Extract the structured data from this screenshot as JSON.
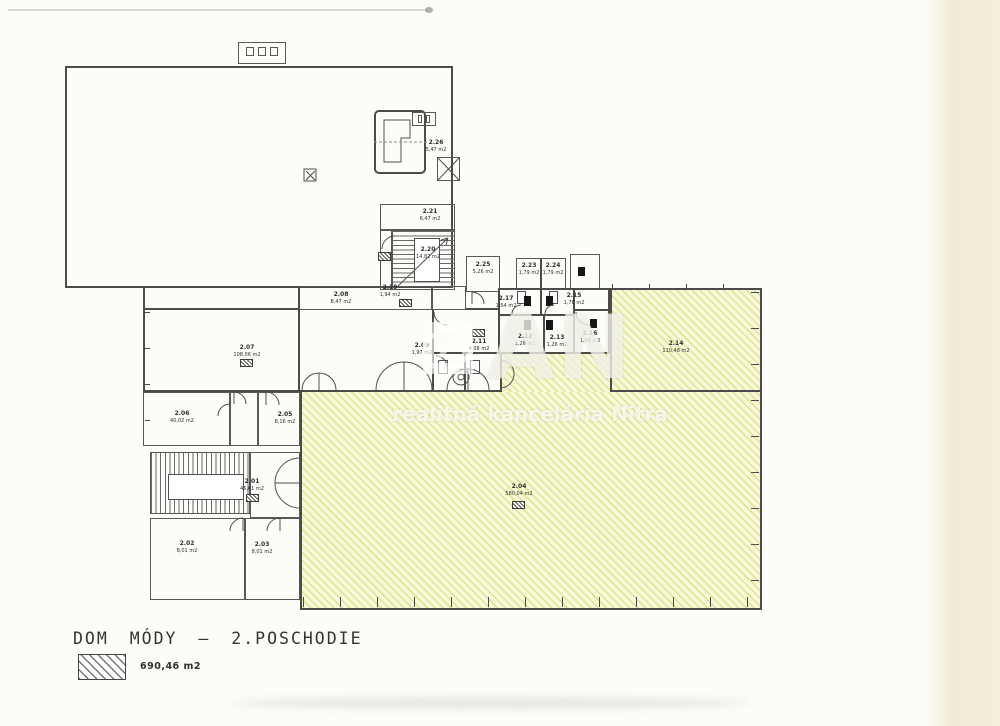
{
  "document": {
    "title": "DOM MÓDY – 2.POSCHODIE"
  },
  "legend": {
    "label": "690,46 m2"
  },
  "watermark": {
    "logo_text": "AN",
    "caption": "realitná kancelária Nitra"
  },
  "colors": {
    "hatch_line": "#e3e58c",
    "hatch_bg": "#f8f8df",
    "wall": "#4b4b4b",
    "paper": "#fcfcf9"
  },
  "rooms": [
    {
      "code": "2.26",
      "area": "5,47 m2"
    },
    {
      "code": "2.21",
      "area": "6,47 m2"
    },
    {
      "code": "2.20",
      "area": "14,82 m2"
    },
    {
      "code": "2.19",
      "area": "1,94 m2"
    },
    {
      "code": "2.08",
      "area": "8,47 m2"
    },
    {
      "code": "2.25",
      "area": "5,26 m2"
    },
    {
      "code": "2.23",
      "area": "1,79 m2"
    },
    {
      "code": "2.24",
      "area": "1,79 m2"
    },
    {
      "code": "2.17",
      "area": "1,54 m2"
    },
    {
      "code": "2.15",
      "area": "1,78 m2"
    },
    {
      "code": "2.09",
      "area": "1,97 m2"
    },
    {
      "code": "2.11",
      "area": "4,08 m2"
    },
    {
      "code": "2.12",
      "area": "1,26 m2"
    },
    {
      "code": "2.13",
      "area": "1,26 m2"
    },
    {
      "code": "2.16",
      "area": "1,58 m2"
    },
    {
      "code": "2.14",
      "area": "110,48 m2"
    },
    {
      "code": "2.07",
      "area": "108,06 m2"
    },
    {
      "code": "2.06",
      "area": "40,02 m2"
    },
    {
      "code": "2.05",
      "area": "8,16 m2"
    },
    {
      "code": "2.01",
      "area": "46,61 m2"
    },
    {
      "code": "2.02",
      "area": "8,01 m2"
    },
    {
      "code": "2.03",
      "area": "8,01 m2"
    },
    {
      "code": "2.04",
      "area": "580,04 m2"
    }
  ]
}
